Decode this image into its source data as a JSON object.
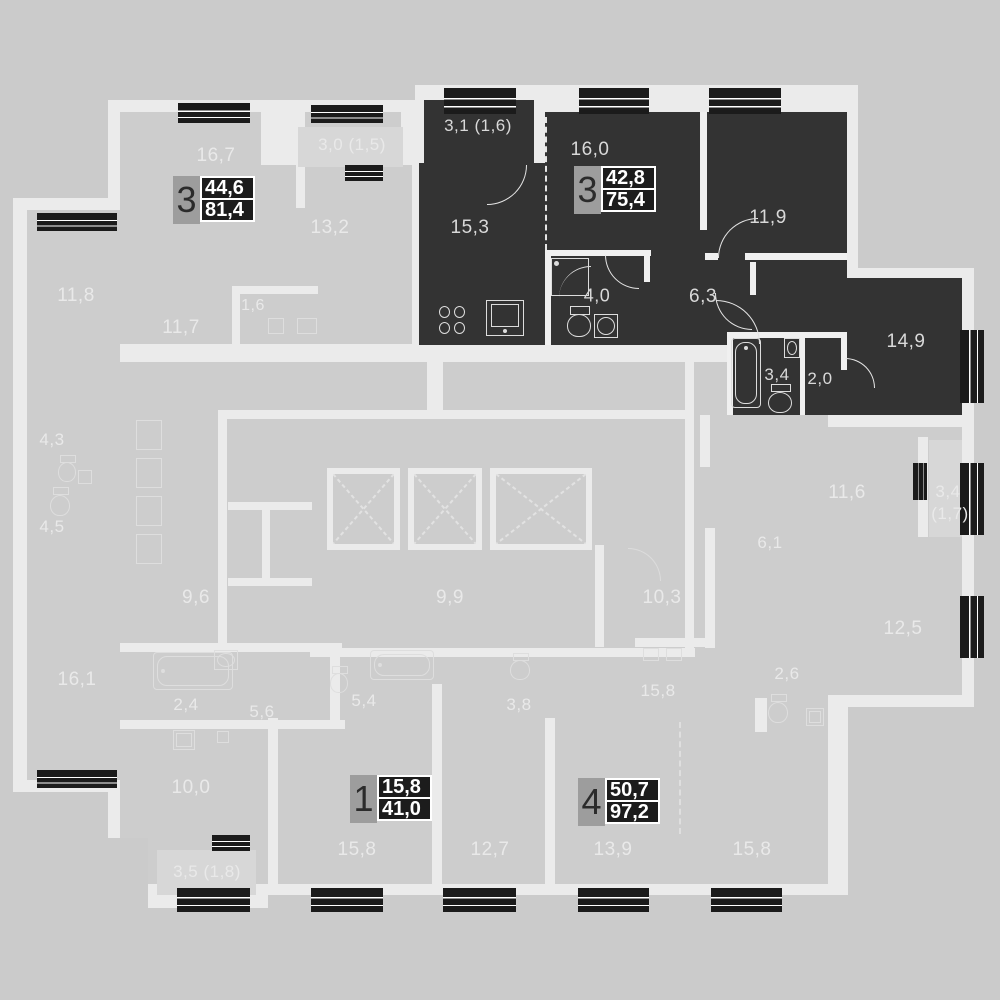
{
  "title": "floor-plan",
  "palette": {
    "bg": "#cbcbcb",
    "wall": "#ebebeb",
    "wall_dark_apt": "#f0f0f0",
    "room": "#cdcdcd",
    "balcony": "#d7d7d7",
    "selected": "#333333",
    "window": "#1b1b1b",
    "label_light": "#e9e9e9",
    "label_dark": "#d9d9d9",
    "badge_gray": "#9d9d9d",
    "badge_black": "#1c1c1c"
  },
  "apartments": [
    {
      "rooms_digit": "3",
      "area_top": "44,6",
      "area_bottom": "81,4",
      "selected": false
    },
    {
      "rooms_digit": "3",
      "area_top": "42,8",
      "area_bottom": "75,4",
      "selected": true
    },
    {
      "rooms_digit": "1",
      "area_top": "15,8",
      "area_bottom": "41,0",
      "selected": false
    },
    {
      "rooms_digit": "4",
      "area_top": "50,7",
      "area_bottom": "97,2",
      "selected": false
    }
  ],
  "badges": [
    {
      "digit": "3",
      "top": "44,6",
      "bottom": "81,4",
      "x": 173,
      "y": 176
    },
    {
      "digit": "3",
      "top": "42,8",
      "bottom": "75,4",
      "x": 574,
      "y": 166
    },
    {
      "digit": "1",
      "top": "15,8",
      "bottom": "41,0",
      "x": 350,
      "y": 775
    },
    {
      "digit": "4",
      "top": "50,7",
      "bottom": "97,2",
      "x": 578,
      "y": 778
    }
  ],
  "labels": [
    {
      "t": "16,7",
      "x": 216,
      "y": 156,
      "on": "light",
      "s": 19
    },
    {
      "t": "3,0 (1,5)",
      "x": 352,
      "y": 145,
      "on": "light",
      "s": 17
    },
    {
      "t": "13,2",
      "x": 330,
      "y": 228,
      "on": "light",
      "s": 19
    },
    {
      "t": "1,6",
      "x": 253,
      "y": 306,
      "on": "light",
      "s": 16
    },
    {
      "t": "11,8",
      "x": 76,
      "y": 296,
      "on": "light",
      "s": 19
    },
    {
      "t": "11,7",
      "x": 181,
      "y": 328,
      "on": "light",
      "s": 19
    },
    {
      "t": "4,3",
      "x": 52,
      "y": 440,
      "on": "light",
      "s": 17
    },
    {
      "t": "4,5",
      "x": 52,
      "y": 527,
      "on": "light",
      "s": 17
    },
    {
      "t": "9,6",
      "x": 196,
      "y": 598,
      "on": "light",
      "s": 19
    },
    {
      "t": "16,1",
      "x": 77,
      "y": 680,
      "on": "light",
      "s": 19
    },
    {
      "t": "2,4",
      "x": 186,
      "y": 705,
      "on": "light",
      "s": 17
    },
    {
      "t": "5,6",
      "x": 262,
      "y": 712,
      "on": "light",
      "s": 17
    },
    {
      "t": "10,0",
      "x": 191,
      "y": 788,
      "on": "light",
      "s": 19
    },
    {
      "t": "3,5 (1,8)",
      "x": 207,
      "y": 872,
      "on": "light",
      "s": 17
    },
    {
      "t": "15,8",
      "x": 357,
      "y": 850,
      "on": "light",
      "s": 19
    },
    {
      "t": "5,4",
      "x": 364,
      "y": 701,
      "on": "light",
      "s": 17
    },
    {
      "t": "9,9",
      "x": 450,
      "y": 598,
      "on": "light",
      "s": 19
    },
    {
      "t": "3,8",
      "x": 519,
      "y": 705,
      "on": "light",
      "s": 17
    },
    {
      "t": "12,7",
      "x": 490,
      "y": 850,
      "on": "light",
      "s": 19
    },
    {
      "t": "13,9",
      "x": 613,
      "y": 850,
      "on": "light",
      "s": 19
    },
    {
      "t": "15,8",
      "x": 658,
      "y": 691,
      "on": "light",
      "s": 17
    },
    {
      "t": "10,3",
      "x": 662,
      "y": 598,
      "on": "light",
      "s": 19
    },
    {
      "t": "15,8",
      "x": 752,
      "y": 850,
      "on": "light",
      "s": 19
    },
    {
      "t": "11,6",
      "x": 847,
      "y": 493,
      "on": "light",
      "s": 19
    },
    {
      "t": "3,4",
      "x": 948,
      "y": 492,
      "on": "light",
      "s": 17
    },
    {
      "t": "(1,7)",
      "x": 950,
      "y": 514,
      "on": "light",
      "s": 17
    },
    {
      "t": "6,1",
      "x": 770,
      "y": 543,
      "on": "light",
      "s": 17
    },
    {
      "t": "12,5",
      "x": 903,
      "y": 629,
      "on": "light",
      "s": 19
    },
    {
      "t": "2,6",
      "x": 787,
      "y": 674,
      "on": "light",
      "s": 17
    },
    {
      "t": "3,1 (1,6)",
      "x": 478,
      "y": 126,
      "on": "dark",
      "s": 17
    },
    {
      "t": "16,0",
      "x": 590,
      "y": 150,
      "on": "dark",
      "s": 19
    },
    {
      "t": "15,3",
      "x": 470,
      "y": 228,
      "on": "dark",
      "s": 19
    },
    {
      "t": "11,9",
      "x": 768,
      "y": 218,
      "on": "dark",
      "s": 19
    },
    {
      "t": "4,0",
      "x": 597,
      "y": 296,
      "on": "dark",
      "s": 18
    },
    {
      "t": "6,3",
      "x": 703,
      "y": 297,
      "on": "dark",
      "s": 19
    },
    {
      "t": "14,9",
      "x": 906,
      "y": 342,
      "on": "dark",
      "s": 19
    },
    {
      "t": "3,4",
      "x": 777,
      "y": 375,
      "on": "dark",
      "s": 17
    },
    {
      "t": "2,0",
      "x": 820,
      "y": 379,
      "on": "dark",
      "s": 17
    }
  ],
  "white_slabs": [
    {
      "r": [
        108,
        100,
        318,
        256
      ]
    },
    {
      "r": [
        13,
        198,
        107,
        594
      ]
    },
    {
      "r": [
        108,
        350,
        740,
        545
      ]
    },
    {
      "r": [
        415,
        85,
        443,
        270
      ]
    },
    {
      "r": [
        752,
        268,
        222,
        157
      ]
    },
    {
      "r": [
        700,
        415,
        274,
        292
      ]
    },
    {
      "r": [
        145,
        838,
        123,
        70
      ]
    }
  ],
  "room_fills": [
    {
      "r": [
        120,
        112,
        292,
        232
      ]
    },
    {
      "r": [
        27,
        210,
        93,
        570
      ]
    },
    {
      "r": [
        120,
        362,
        708,
        522
      ]
    },
    {
      "r": [
        712,
        427,
        250,
        268
      ]
    }
  ],
  "balcony_fills": [
    {
      "r": [
        298,
        127,
        105,
        40
      ]
    },
    {
      "r": [
        929,
        440,
        33,
        97
      ]
    },
    {
      "r": [
        157,
        850,
        99,
        45
      ]
    }
  ],
  "bg_patches": [
    {
      "r": [
        108,
        838,
        40,
        70
      ]
    }
  ],
  "walls": [
    {
      "r": [
        296,
        112,
        9,
        96
      ]
    },
    {
      "r": [
        261,
        112,
        39,
        53
      ]
    },
    {
      "r": [
        401,
        112,
        14,
        53
      ]
    },
    {
      "r": [
        232,
        286,
        86,
        8
      ]
    },
    {
      "r": [
        232,
        286,
        8,
        58
      ]
    },
    {
      "r": [
        220,
        410,
        473,
        9
      ]
    },
    {
      "r": [
        218,
        410,
        9,
        240
      ]
    },
    {
      "r": [
        310,
        648,
        385,
        9
      ]
    },
    {
      "r": [
        685,
        356,
        9,
        301
      ]
    },
    {
      "r": [
        427,
        356,
        16,
        56
      ]
    },
    {
      "r": [
        228,
        502,
        84,
        8
      ]
    },
    {
      "r": [
        228,
        578,
        84,
        8
      ]
    },
    {
      "r": [
        262,
        502,
        8,
        84
      ]
    },
    {
      "r": [
        268,
        718,
        10,
        170
      ]
    },
    {
      "r": [
        432,
        684,
        10,
        204
      ]
    },
    {
      "r": [
        545,
        718,
        10,
        170
      ]
    },
    {
      "r": [
        755,
        698,
        12,
        34
      ]
    },
    {
      "r": [
        120,
        643,
        222,
        9
      ]
    },
    {
      "r": [
        330,
        643,
        10,
        84
      ]
    },
    {
      "r": [
        120,
        720,
        225,
        9
      ]
    },
    {
      "r": [
        705,
        528,
        10,
        120
      ]
    },
    {
      "r": [
        635,
        638,
        78,
        9
      ]
    },
    {
      "r": [
        700,
        415,
        10,
        52
      ]
    },
    {
      "r": [
        918,
        437,
        10,
        100
      ]
    },
    {
      "r": [
        595,
        545,
        9,
        102
      ]
    },
    {
      "r": [
        545,
        250,
        106,
        6
      ],
      "c": "#f0f0f0"
    },
    {
      "r": [
        545,
        250,
        6,
        95
      ],
      "c": "#f0f0f0"
    },
    {
      "r": [
        644,
        250,
        6,
        32
      ],
      "c": "#f0f0f0"
    },
    {
      "r": [
        700,
        112,
        7,
        118
      ],
      "c": "#f0f0f0"
    },
    {
      "r": [
        705,
        253,
        13,
        7
      ],
      "c": "#f0f0f0"
    },
    {
      "r": [
        745,
        253,
        102,
        7
      ],
      "c": "#f0f0f0"
    },
    {
      "r": [
        750,
        262,
        6,
        33
      ],
      "c": "#f0f0f0"
    },
    {
      "r": [
        727,
        332,
        120,
        6
      ],
      "c": "#f0f0f0"
    },
    {
      "r": [
        727,
        332,
        6,
        83
      ],
      "c": "#f0f0f0"
    },
    {
      "r": [
        800,
        338,
        5,
        77
      ],
      "c": "#f0f0f0"
    },
    {
      "r": [
        841,
        338,
        6,
        32
      ],
      "c": "#f0f0f0"
    }
  ],
  "selected_area": [
    {
      "r": [
        424,
        100,
        110,
        78
      ]
    },
    {
      "r": [
        419,
        163,
        126,
        182
      ]
    },
    {
      "r": [
        545,
        112,
        160,
        233
      ]
    },
    {
      "r": [
        705,
        112,
        142,
        147
      ]
    },
    {
      "r": [
        648,
        259,
        112,
        86
      ]
    },
    {
      "r": [
        756,
        259,
        91,
        156
      ]
    },
    {
      "r": [
        764,
        278,
        198,
        137
      ]
    },
    {
      "r": [
        727,
        332,
        120,
        83
      ]
    }
  ],
  "windows": [
    {
      "r": [
        178,
        103,
        72,
        20
      ],
      "o": "h"
    },
    {
      "r": [
        311,
        105,
        72,
        18
      ],
      "o": "h"
    },
    {
      "r": [
        444,
        88,
        72,
        26
      ],
      "o": "h"
    },
    {
      "r": [
        579,
        88,
        70,
        26
      ],
      "o": "h"
    },
    {
      "r": [
        709,
        88,
        72,
        26
      ],
      "o": "h"
    },
    {
      "r": [
        37,
        213,
        80,
        18
      ],
      "o": "h"
    },
    {
      "r": [
        345,
        165,
        38,
        16
      ],
      "o": "h"
    },
    {
      "r": [
        37,
        770,
        80,
        18
      ],
      "o": "h"
    },
    {
      "r": [
        177,
        888,
        73,
        24
      ],
      "o": "h"
    },
    {
      "r": [
        311,
        888,
        72,
        24
      ],
      "o": "h"
    },
    {
      "r": [
        443,
        888,
        73,
        24
      ],
      "o": "h"
    },
    {
      "r": [
        578,
        888,
        71,
        24
      ],
      "o": "h"
    },
    {
      "r": [
        711,
        888,
        71,
        24
      ],
      "o": "h"
    },
    {
      "r": [
        212,
        835,
        38,
        16
      ],
      "o": "h"
    },
    {
      "r": [
        960,
        330,
        24,
        73
      ],
      "o": "v"
    },
    {
      "r": [
        960,
        463,
        24,
        72
      ],
      "o": "v"
    },
    {
      "r": [
        960,
        596,
        24,
        62
      ],
      "o": "v"
    },
    {
      "r": [
        913,
        463,
        14,
        37
      ],
      "o": "v"
    }
  ],
  "shafts": [
    {
      "r": [
        327,
        468,
        73,
        82
      ]
    },
    {
      "r": [
        408,
        468,
        74,
        82
      ]
    },
    {
      "r": [
        490,
        468,
        102,
        82
      ]
    }
  ],
  "arcs": [
    {
      "x": 487,
      "y": 165,
      "r": 40,
      "q": "br",
      "on": "dark"
    },
    {
      "x": 605,
      "y": 255,
      "r": 34,
      "q": "bl",
      "on": "dark"
    },
    {
      "x": 718,
      "y": 218,
      "r": 40,
      "q": "tl",
      "on": "dark"
    },
    {
      "x": 715,
      "y": 293,
      "r": 37,
      "q": "bl",
      "on": "dark"
    },
    {
      "x": 845,
      "y": 358,
      "r": 30,
      "q": "tr",
      "on": "dark"
    },
    {
      "x": 716,
      "y": 300,
      "r": 44,
      "q": "tr",
      "on": "dark"
    },
    {
      "x": 628,
      "y": 548,
      "r": 33,
      "q": "tr",
      "on": "light"
    }
  ],
  "dashes": [
    {
      "x": 545,
      "y": 117,
      "len": 133,
      "v": true,
      "c": "#e6e6e6"
    },
    {
      "x": 679,
      "y": 722,
      "len": 112,
      "v": true,
      "c": "#dfdfdf"
    }
  ],
  "fixtures": [
    {
      "k": "stove",
      "r": [
        438,
        305,
        30,
        32
      ],
      "on": "dark"
    },
    {
      "k": "sink",
      "r": [
        486,
        300,
        38,
        36
      ],
      "on": "dark"
    },
    {
      "k": "shower",
      "r": [
        551,
        258,
        38,
        38
      ],
      "on": "dark"
    },
    {
      "k": "toilet",
      "r": [
        567,
        306,
        26,
        32
      ],
      "on": "dark"
    },
    {
      "k": "basin",
      "r": [
        594,
        314,
        24,
        24
      ],
      "on": "dark"
    },
    {
      "k": "tub-v",
      "r": [
        731,
        338,
        30,
        70
      ],
      "on": "dark"
    },
    {
      "k": "basin",
      "r": [
        784,
        338,
        16,
        20
      ],
      "on": "dark"
    },
    {
      "k": "toilet",
      "r": [
        768,
        384,
        26,
        30
      ],
      "on": "dark"
    },
    {
      "k": "tub-h",
      "r": [
        153,
        652,
        80,
        38
      ],
      "on": "light"
    },
    {
      "k": "basin",
      "r": [
        214,
        650,
        24,
        20
      ],
      "on": "light"
    },
    {
      "k": "tub-h",
      "r": [
        370,
        650,
        64,
        30
      ],
      "on": "light"
    },
    {
      "k": "toilet",
      "r": [
        330,
        666,
        20,
        28
      ],
      "on": "light"
    },
    {
      "k": "toilet",
      "r": [
        510,
        653,
        22,
        28
      ],
      "on": "light"
    },
    {
      "k": "sq",
      "r": [
        643,
        648,
        16,
        13
      ],
      "on": "light"
    },
    {
      "k": "sq",
      "r": [
        666,
        648,
        16,
        13
      ],
      "on": "light"
    },
    {
      "k": "toilet",
      "r": [
        768,
        694,
        22,
        30
      ],
      "on": "light"
    },
    {
      "k": "washer",
      "r": [
        806,
        708,
        18,
        18
      ],
      "on": "light"
    },
    {
      "k": "washer",
      "r": [
        173,
        730,
        22,
        20
      ],
      "on": "light"
    },
    {
      "k": "sq",
      "r": [
        217,
        731,
        12,
        12
      ],
      "on": "light"
    },
    {
      "k": "toilet",
      "r": [
        58,
        455,
        20,
        28
      ],
      "on": "light"
    },
    {
      "k": "toilet",
      "r": [
        50,
        487,
        22,
        30
      ],
      "on": "light"
    },
    {
      "k": "sq",
      "r": [
        78,
        470,
        14,
        14
      ],
      "on": "light"
    },
    {
      "k": "sq",
      "r": [
        136,
        420,
        26,
        30
      ],
      "on": "light"
    },
    {
      "k": "sq",
      "r": [
        136,
        458,
        26,
        30
      ],
      "on": "light"
    },
    {
      "k": "sq",
      "r": [
        136,
        496,
        26,
        30
      ],
      "on": "light"
    },
    {
      "k": "sq",
      "r": [
        136,
        534,
        26,
        30
      ],
      "on": "light"
    },
    {
      "k": "sq",
      "r": [
        268,
        318,
        16,
        16
      ],
      "on": "light"
    },
    {
      "k": "sq",
      "r": [
        297,
        318,
        20,
        16
      ],
      "on": "light"
    }
  ]
}
